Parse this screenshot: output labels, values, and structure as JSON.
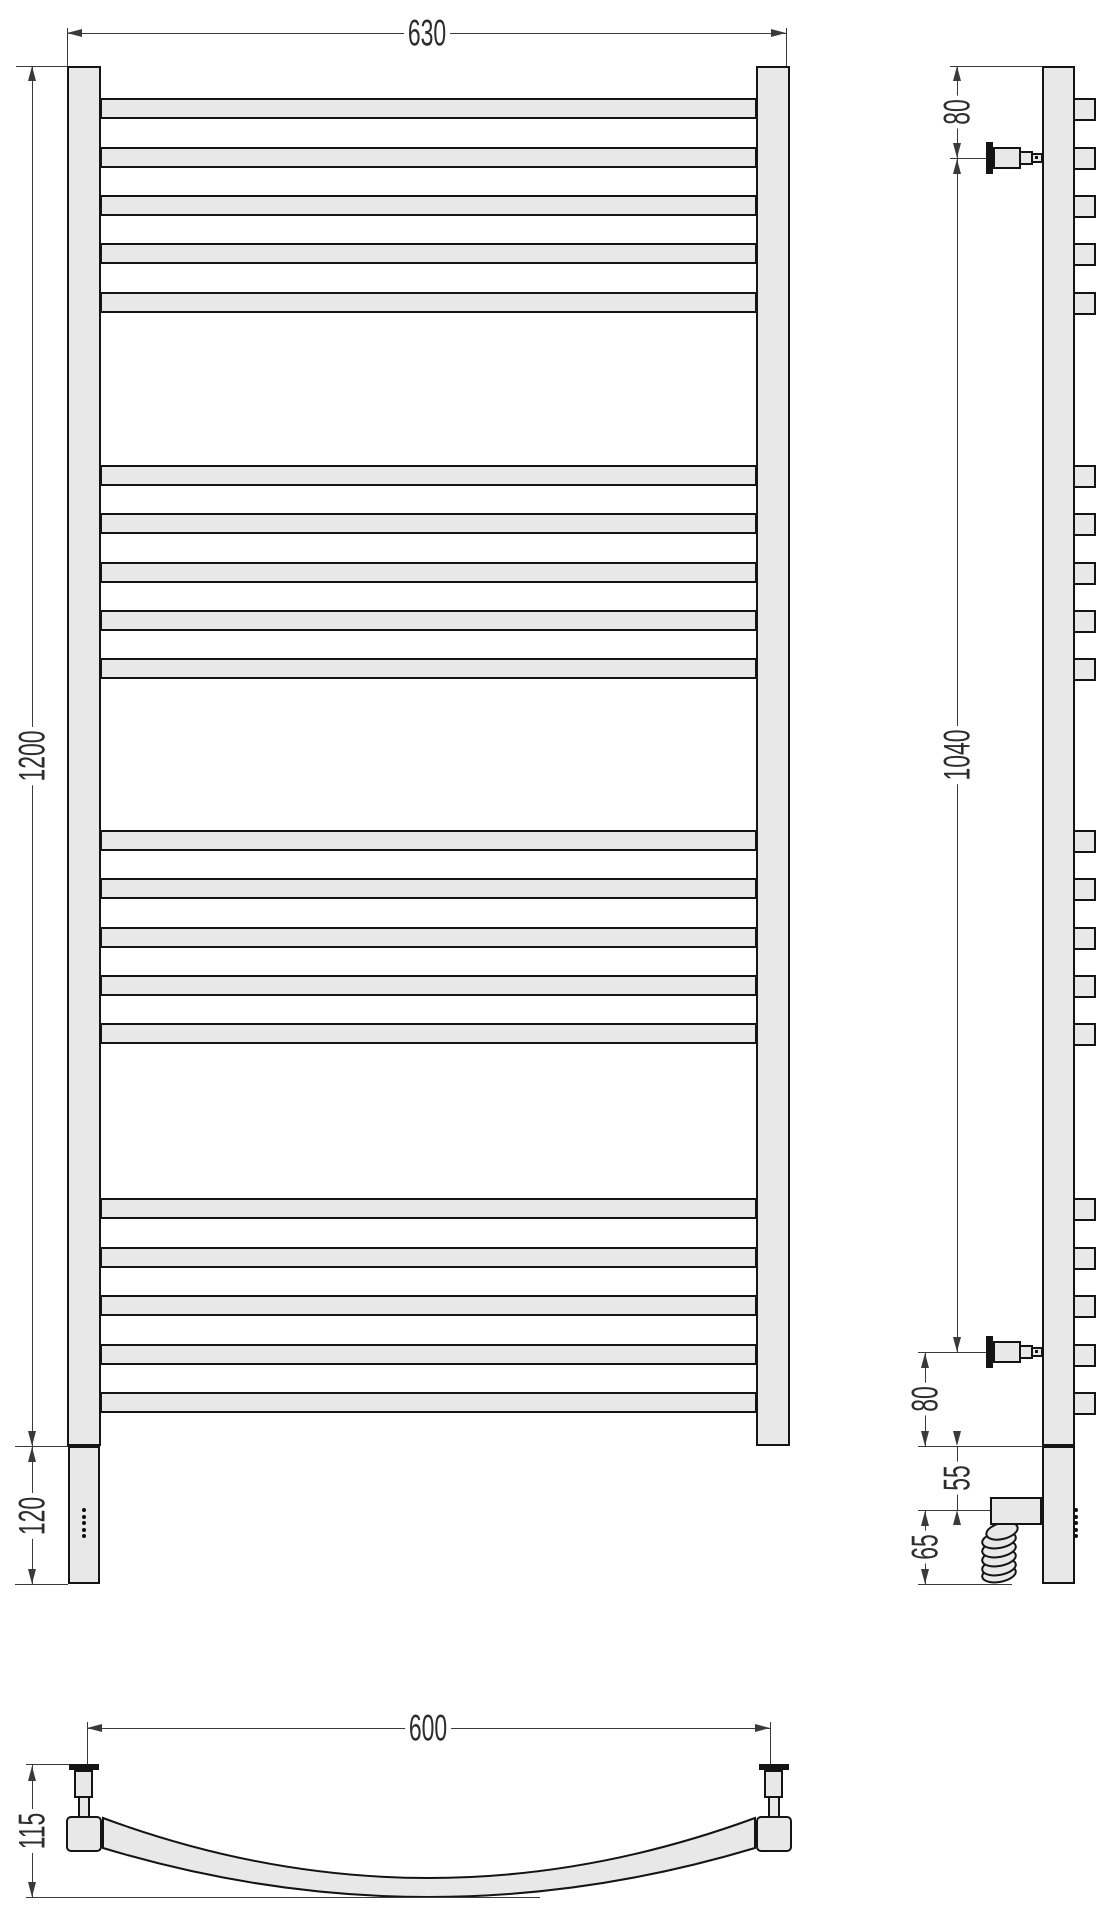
{
  "front_view": {
    "overall_width_mm": "630",
    "overall_height_mm": "1200",
    "heater_section_mm": "120"
  },
  "side_view": {
    "top_bracket_offset_mm": "80",
    "bracket_span_mm": "1040",
    "bottom_bracket_offset_mm": "80",
    "union_section_mm": "55",
    "heater_element_mm": "65"
  },
  "bottom_view": {
    "mount_centers_mm": "600",
    "depth_mm": "115"
  },
  "colors": {
    "body_fill": "#e8e8e8",
    "outline": "#141414",
    "dimension_line": "#3a3a3a",
    "background": "#ffffff"
  }
}
